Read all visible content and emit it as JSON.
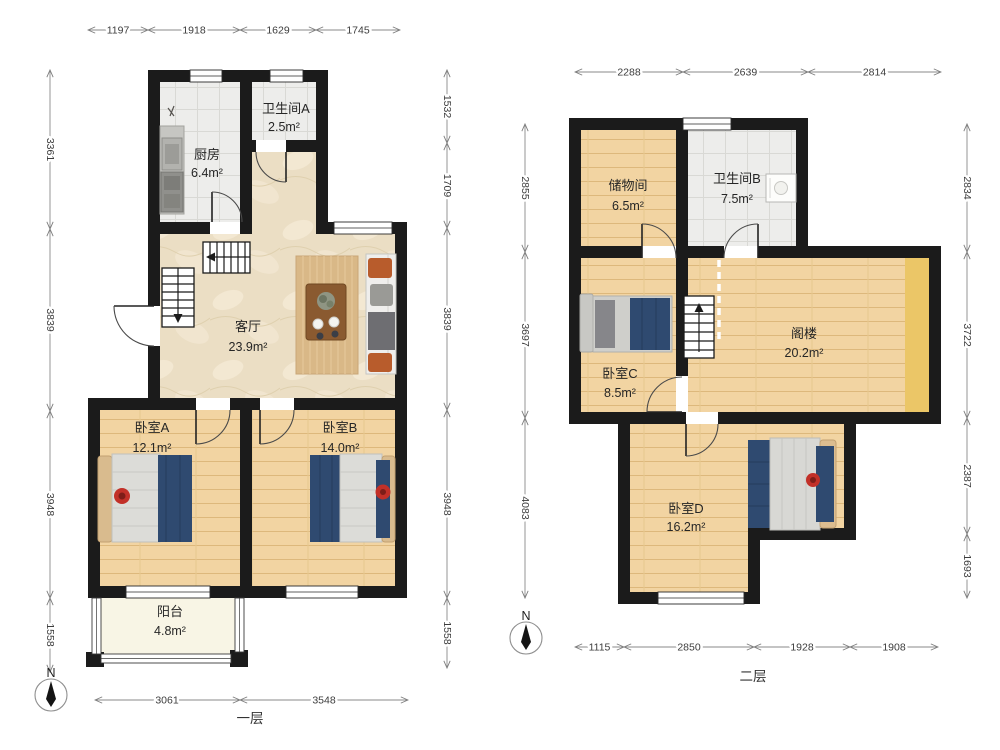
{
  "floor1": {
    "label": "一层",
    "compass_label": "N",
    "rooms": {
      "kitchen": {
        "name": "厨房",
        "area": "6.4m²"
      },
      "bath_a": {
        "name": "卫生间A",
        "area": "2.5m²"
      },
      "living": {
        "name": "客厅",
        "area": "23.9m²"
      },
      "bed_a": {
        "name": "卧室A",
        "area": "12.1m²"
      },
      "bed_b": {
        "name": "卧室B",
        "area": "14.0m²"
      },
      "balcony": {
        "name": "阳台",
        "area": "4.8m²"
      }
    },
    "dims": {
      "top": [
        "1197",
        "1918",
        "1629",
        "1745"
      ],
      "left": [
        "3361",
        "3839",
        "3948",
        "1558"
      ],
      "right": [
        "1532",
        "1709",
        "3839",
        "3948",
        "1558"
      ],
      "bottom": [
        "3061",
        "3548"
      ]
    }
  },
  "floor2": {
    "label": "二层",
    "compass_label": "N",
    "rooms": {
      "storage": {
        "name": "储物间",
        "area": "6.5m²"
      },
      "bath_b": {
        "name": "卫生间B",
        "area": "7.5m²"
      },
      "bed_c": {
        "name": "卧室C",
        "area": "8.5m²"
      },
      "attic": {
        "name": "阁楼",
        "area": "20.2m²"
      },
      "bed_d": {
        "name": "卧室D",
        "area": "16.2m²"
      }
    },
    "dims": {
      "top": [
        "2288",
        "2639",
        "2814"
      ],
      "left": [
        "2855",
        "3697",
        "4083"
      ],
      "right": [
        "2834",
        "3722",
        "2387",
        "1693"
      ],
      "bottom": [
        "1115",
        "2850",
        "1928",
        "1908"
      ]
    }
  },
  "colors": {
    "wall": "#1b1b1b",
    "wood_floor": "#f2d4a2",
    "marble_floor": "#ebdec4",
    "tile_floor": "#ededeb",
    "balcony_floor": "#f8f5e5",
    "attic_strip": "#ebc667",
    "bed_navy": "#2f4a70",
    "accent_red": "#c23028",
    "sofa_orange": "#b85c2c"
  }
}
